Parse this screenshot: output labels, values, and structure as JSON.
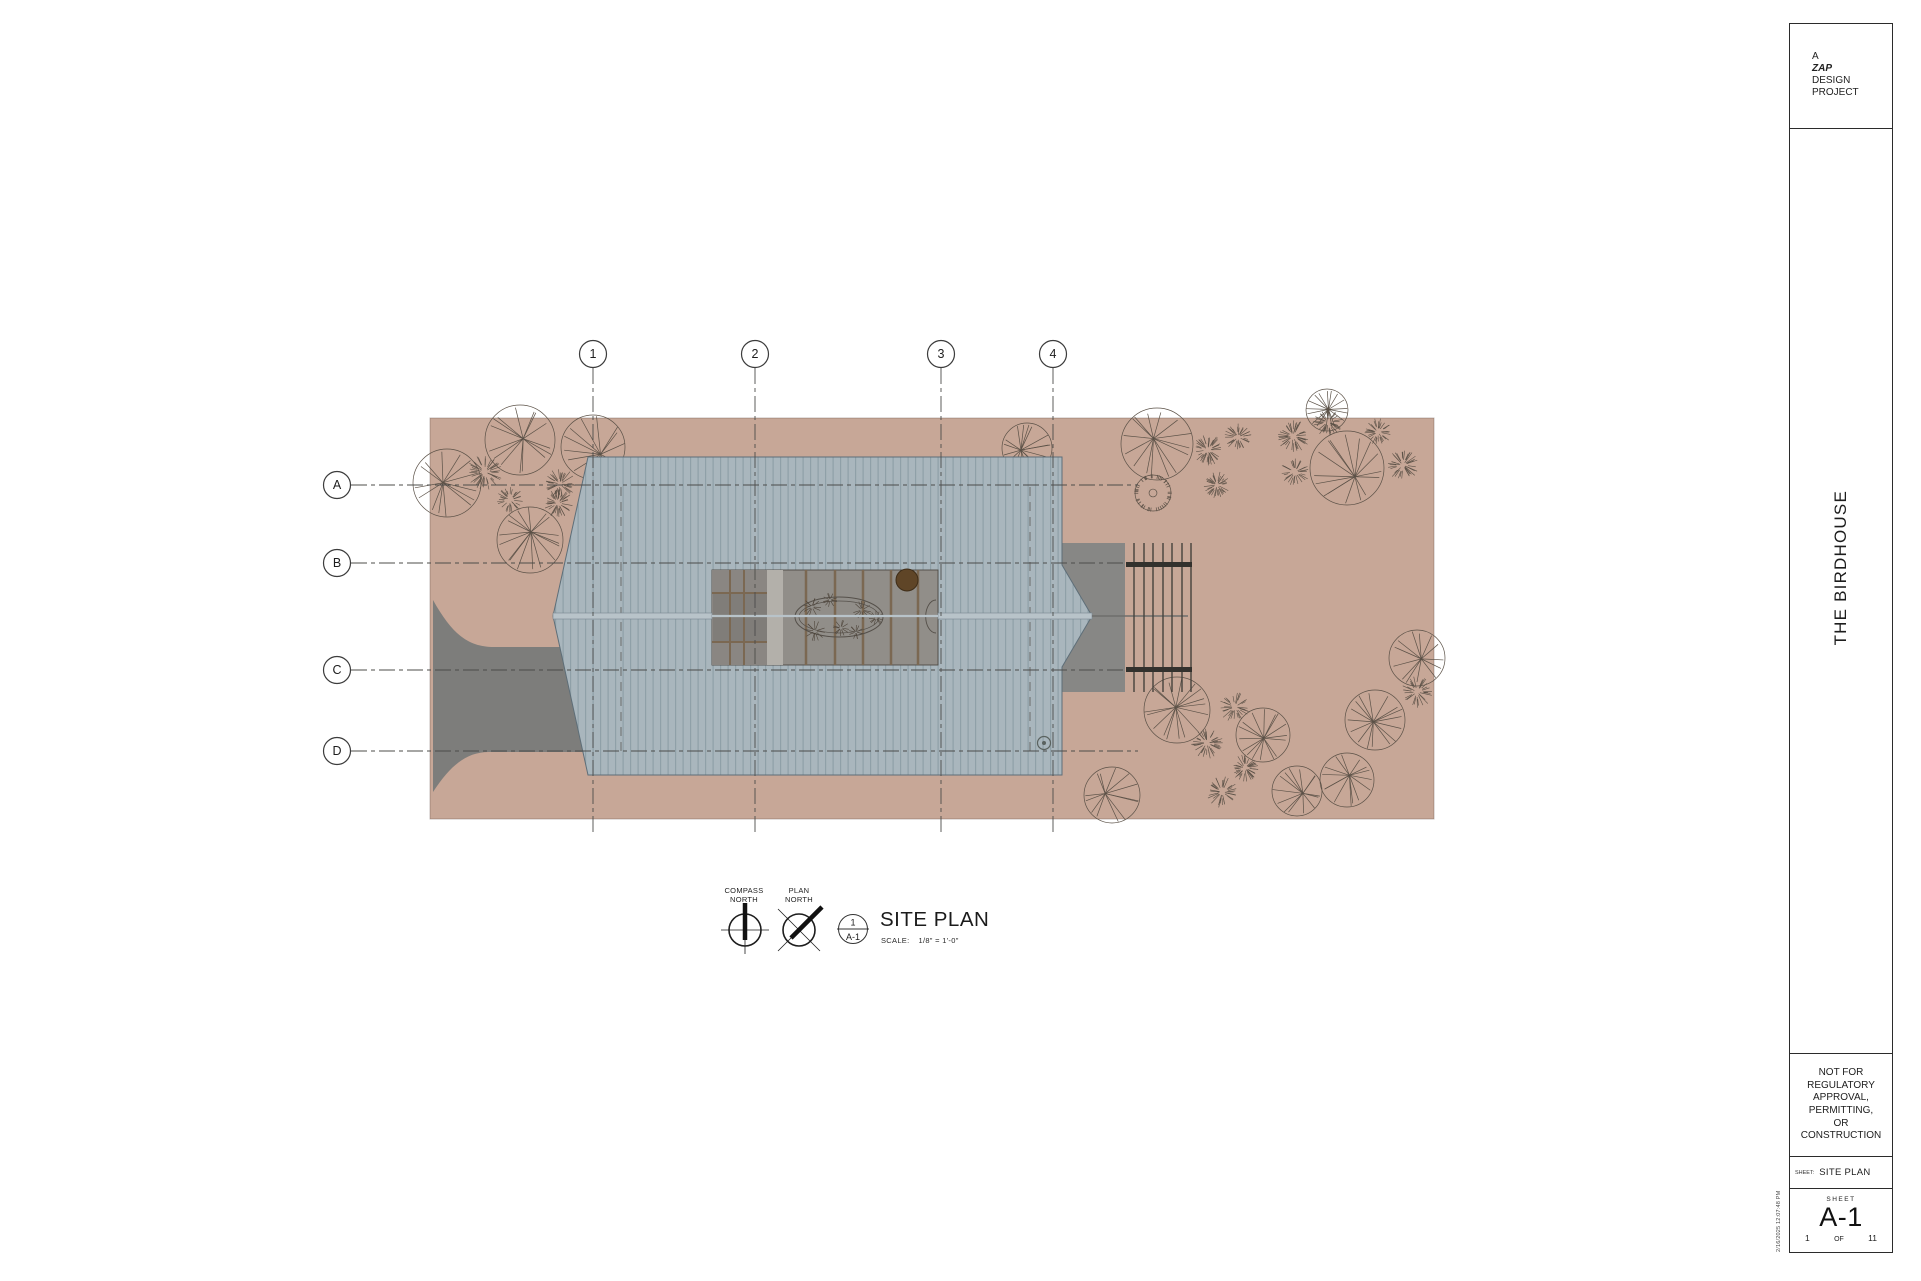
{
  "title_block": {
    "logo": [
      "A",
      "ZAP",
      "DESIGN",
      "PROJECT"
    ],
    "project_name": "THE BIRDHOUSE",
    "disclaimer_lines": [
      "NOT FOR",
      "REGULATORY",
      "APPROVAL,",
      "PERMITTING,",
      "OR",
      "CONSTRUCTION"
    ],
    "sheet_label": "SHEET:",
    "sheet_title": "SITE PLAN",
    "sheet_word": "SHEET",
    "sheet_number": "A-1",
    "page_current": "1",
    "page_of": "OF",
    "page_total": "11",
    "timestamp": "2/16/2025 12:07:48 PM"
  },
  "legend": {
    "compass_north": [
      "COMPASS",
      "NORTH"
    ],
    "plan_north": [
      "PLAN",
      "NORTH"
    ],
    "callout_number": "1",
    "callout_sheet": "A-1",
    "view_title": "SITE PLAN",
    "scale_label": "SCALE:",
    "scale_value": "1/8\" = 1'-0\""
  },
  "grid": {
    "bubble_radius": 13.5,
    "col_bubble_y": 354,
    "row_bubble_x": 337,
    "col_line_y1": 368,
    "col_line_y2": 833,
    "row_line_x1": 351,
    "columns": [
      {
        "label": "1",
        "x": 593
      },
      {
        "label": "2",
        "x": 755
      },
      {
        "label": "3",
        "x": 941
      },
      {
        "label": "4",
        "x": 1053
      }
    ],
    "rows": [
      {
        "label": "A",
        "y": 485,
        "x2": 1138
      },
      {
        "label": "B",
        "y": 563,
        "x2": 1126
      },
      {
        "label": "C",
        "y": 670,
        "x2": 1126
      },
      {
        "label": "D",
        "y": 751,
        "x2": 1138
      }
    ]
  },
  "plan": {
    "colors": {
      "site": "#c7a797",
      "site_border": "rgba(90,70,60,0.35)",
      "roof": "#a9b6bd",
      "seam": "#8fa0a8",
      "roof_edge": "#5e6e78",
      "ridge": "#b8c3c9",
      "ridge_edge": "#78868f",
      "driveway": "#7d7d7b",
      "porch": "#878785",
      "court_base": "#8f8c87",
      "court_left": "#8a8682",
      "court_inner": "#807d79",
      "court_strip": "#b3b0aa",
      "court_deck": "#918e89",
      "court_edge": "#4f4a44",
      "joist": "#7b6852",
      "oval_line": "#55504a",
      "plant_line": "#4f463c",
      "round_tree_fill": "#5f4527",
      "round_tree_edge": "#3f2d18",
      "trellis_line": "#45423c",
      "beam": "#33312d",
      "tree_line": "#5b5147",
      "grid_line": "#4c4c4a",
      "bubble_stroke": "#3c3c3c",
      "wall_dash": "#5a5a58",
      "vent": "#5a625f",
      "text": "#1d1d1d"
    },
    "site": {
      "x": 430,
      "y": 418,
      "w": 1004,
      "h": 401
    },
    "driveway_path": "M 433,600 C 452,634 468,647 494,647 L 588,647 L 588,752 L 489,752 C 466,752 450,766 433,792 Z",
    "roof": {
      "points": "588,457 1062,457 1062,565 1092,616 1062,667 1062,775 588,775 553,616",
      "seam_spacing": 7.5
    },
    "porch": {
      "x": 1062,
      "y": 543,
      "w": 63,
      "h": 149
    },
    "ridge": {
      "x1": 553,
      "x2": 1092,
      "y": 616,
      "h": 6,
      "tail_x2": 1188
    },
    "roof_vent": {
      "cx": 1044,
      "cy": 743,
      "r": 6.5
    },
    "wall_dashes": [
      {
        "x": 621,
        "y1": 487,
        "y2": 753
      },
      {
        "x": 1030,
        "y1": 487,
        "y2": 753
      }
    ],
    "courtyard": {
      "x": 712,
      "y": 570,
      "w": 226,
      "h": 95,
      "left_panel_w": 55,
      "strip_x": 767,
      "strip_w": 16,
      "inner_y": 593,
      "inner_h": 49,
      "mullions_x": [
        730,
        744
      ],
      "joists_x": [
        806,
        835,
        863,
        891,
        918
      ],
      "oval": {
        "cx": 839,
        "cy": 617,
        "rx": 44,
        "ry": 20
      },
      "plants": [
        [
          812,
          607,
          9
        ],
        [
          830,
          600,
          7
        ],
        [
          815,
          631,
          10
        ],
        [
          841,
          628,
          8
        ],
        [
          862,
          610,
          9
        ],
        [
          856,
          632,
          7
        ],
        [
          876,
          618,
          7
        ]
      ],
      "round_tree": {
        "cx": 907,
        "cy": 580,
        "r": 11
      },
      "door_arc": "M 936,600 A 10 16 0 0 0 936,633"
    },
    "trellis": {
      "verticals_x": [
        1134,
        1144,
        1153,
        1163,
        1172,
        1182,
        1191
      ],
      "y1": 543,
      "y2": 692,
      "beams": [
        {
          "x": 1126,
          "y": 562,
          "w": 66,
          "h": 5
        },
        {
          "x": 1126,
          "y": 667,
          "w": 66,
          "h": 5
        }
      ]
    },
    "trees": [
      {
        "t": "c",
        "x": 520,
        "y": 440,
        "r": 35
      },
      {
        "t": "c",
        "x": 593,
        "y": 447,
        "r": 32
      },
      {
        "t": "c",
        "x": 447,
        "y": 483,
        "r": 34
      },
      {
        "t": "c",
        "x": 530,
        "y": 540,
        "r": 33
      },
      {
        "t": "s",
        "x": 485,
        "y": 472,
        "r": 17
      },
      {
        "t": "s",
        "x": 510,
        "y": 500,
        "r": 13
      },
      {
        "t": "s",
        "x": 560,
        "y": 484,
        "r": 15
      },
      {
        "t": "s",
        "x": 558,
        "y": 503,
        "r": 14
      },
      {
        "t": "c",
        "x": 1027,
        "y": 448,
        "r": 25
      },
      {
        "t": "c",
        "x": 1157,
        "y": 444,
        "r": 36
      },
      {
        "t": "f",
        "x": 1153,
        "y": 493,
        "r": 18
      },
      {
        "t": "s",
        "x": 1208,
        "y": 450,
        "r": 15
      },
      {
        "t": "s",
        "x": 1238,
        "y": 437,
        "r": 13
      },
      {
        "t": "s",
        "x": 1217,
        "y": 485,
        "r": 13
      },
      {
        "t": "s",
        "x": 1293,
        "y": 436,
        "r": 16
      },
      {
        "t": "s",
        "x": 1295,
        "y": 472,
        "r": 14
      },
      {
        "t": "s",
        "x": 1328,
        "y": 422,
        "r": 14
      },
      {
        "t": "c",
        "x": 1327,
        "y": 410,
        "r": 21
      },
      {
        "t": "c",
        "x": 1347,
        "y": 468,
        "r": 37
      },
      {
        "t": "s",
        "x": 1378,
        "y": 432,
        "r": 13
      },
      {
        "t": "s",
        "x": 1403,
        "y": 465,
        "r": 15
      },
      {
        "t": "c",
        "x": 1417,
        "y": 658,
        "r": 28
      },
      {
        "t": "s",
        "x": 1417,
        "y": 692,
        "r": 15
      },
      {
        "t": "c",
        "x": 1375,
        "y": 720,
        "r": 30
      },
      {
        "t": "c",
        "x": 1347,
        "y": 780,
        "r": 27
      },
      {
        "t": "c",
        "x": 1297,
        "y": 791,
        "r": 25
      },
      {
        "t": "s",
        "x": 1222,
        "y": 792,
        "r": 15
      },
      {
        "t": "c",
        "x": 1263,
        "y": 735,
        "r": 27
      },
      {
        "t": "s",
        "x": 1245,
        "y": 768,
        "r": 13
      },
      {
        "t": "s",
        "x": 1235,
        "y": 707,
        "r": 15
      },
      {
        "t": "c",
        "x": 1177,
        "y": 710,
        "r": 33
      },
      {
        "t": "s",
        "x": 1207,
        "y": 743,
        "r": 15
      },
      {
        "t": "c",
        "x": 1112,
        "y": 795,
        "r": 28
      }
    ]
  }
}
